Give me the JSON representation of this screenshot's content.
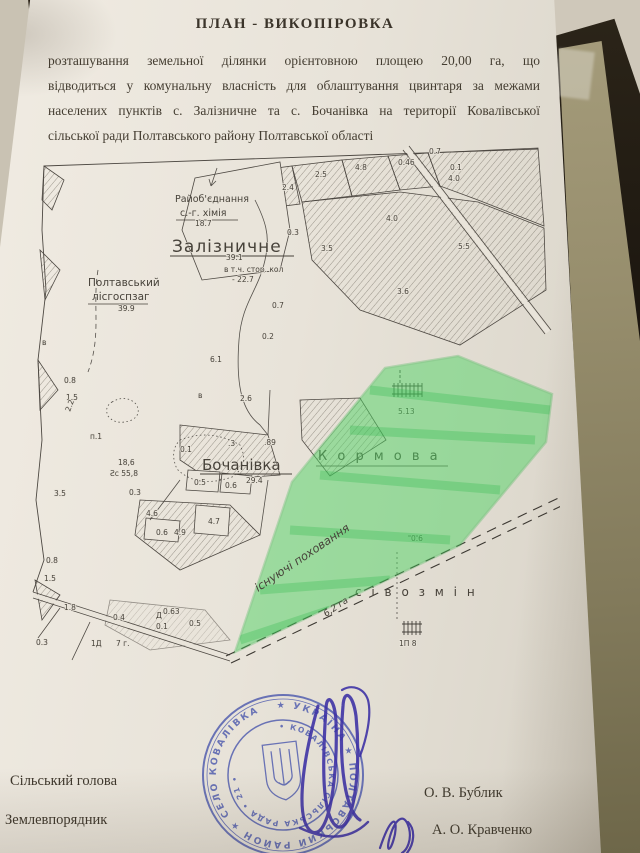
{
  "document": {
    "title": "ПЛАН - ВИКОПІРОВКА",
    "body_lines": [
      "розташування земельної  ділянки орієнтовною площею 20,00 га, що",
      "відводиться  у комунальну власність для облаштування цвинтаря за межами",
      "населених пунктів с. Залізничне та с. Бочанівка на території  Ковалівської",
      "сільської ради Полтавського району Полтавської області"
    ],
    "signatories": [
      {
        "role": "Сільський голова",
        "name": "О. В. Бублик"
      },
      {
        "role": "Землевпорядник",
        "name": "А. О. Кравченко"
      }
    ]
  },
  "map": {
    "place_labels": {
      "rayob_line1": "Райоб'єднання",
      "rayob_line2": "с.-г. хімія",
      "zaliznychne": "Залізничне",
      "poltav_line1": "Полтавський",
      "poltav_line2": "лісгоспзаг",
      "bochanivka": "Бочанівка",
      "kormova": "К о р м о в а",
      "sivozmin": "с і в о з м і н"
    },
    "green_note_line1": "існуючі поховання",
    "green_note_line2": "6,2 га",
    "area_labels": [
      {
        "v": "18.7",
        "x": 165,
        "y": 86
      },
      {
        "v": "39.1",
        "x": 196,
        "y": 120,
        "s": 10
      },
      {
        "v": "в т.ч. стор. кол",
        "x": 194,
        "y": 132,
        "s": 6.5
      },
      {
        "v": "- 22.7",
        "x": 202,
        "y": 142,
        "s": 8
      },
      {
        "v": "39.9",
        "x": 88,
        "y": 171,
        "s": 9
      },
      {
        "v": "2.4",
        "x": 252,
        "y": 50
      },
      {
        "v": "2.5",
        "x": 285,
        "y": 37
      },
      {
        "v": "4.8",
        "x": 325,
        "y": 30
      },
      {
        "v": "0.46",
        "x": 368,
        "y": 25,
        "s": 6.5
      },
      {
        "v": "0.7",
        "x": 399,
        "y": 14
      },
      {
        "v": "0.1",
        "x": 420,
        "y": 30
      },
      {
        "v": "4.0",
        "x": 418,
        "y": 41
      },
      {
        "v": "4.0",
        "x": 356,
        "y": 81,
        "s": 9
      },
      {
        "v": "0.3",
        "x": 257,
        "y": 95,
        "s": 6.5
      },
      {
        "v": "3.5",
        "x": 291,
        "y": 111,
        "s": 9
      },
      {
        "v": "5.5",
        "x": 428,
        "y": 109
      },
      {
        "v": "3.6",
        "x": 367,
        "y": 154
      },
      {
        "v": "0.7",
        "x": 242,
        "y": 168
      },
      {
        "v": "0.2",
        "x": 232,
        "y": 199,
        "s": 6.5
      },
      {
        "v": "6.1",
        "x": 180,
        "y": 222,
        "s": 8.5
      },
      {
        "v": "2.6",
        "x": 210,
        "y": 261,
        "s": 9
      },
      {
        "v": "0.1",
        "x": 150,
        "y": 312
      },
      {
        "v": "п.1",
        "x": 60,
        "y": 299,
        "s": 7
      },
      {
        "v": "18,6",
        "x": 88,
        "y": 325,
        "s": 8
      },
      {
        "v": "Ƨс 55,8",
        "x": 80,
        "y": 336,
        "s": 8.5
      },
      {
        "v": "0.5",
        "x": 164,
        "y": 345
      },
      {
        "v": "0.6",
        "x": 195,
        "y": 348
      },
      {
        "v": ".89",
        "x": 234,
        "y": 305,
        "s": 6.5
      },
      {
        "v": ".3",
        "x": 198,
        "y": 306,
        "s": 6.5
      },
      {
        "v": "29.4",
        "x": 216,
        "y": 343,
        "s": 12
      },
      {
        "v": "0.8",
        "x": 34,
        "y": 243,
        "s": 6.5
      },
      {
        "v": "1.5",
        "x": 36,
        "y": 260,
        "s": 6.5
      },
      {
        "v": "2.2",
        "x": 40,
        "y": 272,
        "s": 6.5,
        "r": -70
      },
      {
        "v": "3.5",
        "x": 24,
        "y": 356,
        "s": 8.5
      },
      {
        "v": "0.3",
        "x": 99,
        "y": 355
      },
      {
        "v": "4.6",
        "x": 116,
        "y": 376,
        "s": 8
      },
      {
        "v": "0.6",
        "x": 126,
        "y": 395
      },
      {
        "v": "4.9",
        "x": 144,
        "y": 395,
        "s": 8
      },
      {
        "v": "4.7",
        "x": 178,
        "y": 384,
        "s": 8.5
      },
      {
        "v": "0.8",
        "x": 16,
        "y": 423,
        "s": 6.5
      },
      {
        "v": "1.5",
        "x": 14,
        "y": 441,
        "s": 6.5
      },
      {
        "v": "1.8",
        "x": 34,
        "y": 470,
        "s": 7.5
      },
      {
        "v": "0.4",
        "x": 83,
        "y": 480
      },
      {
        "v": "Д",
        "x": 126,
        "y": 478,
        "s": 6.5
      },
      {
        "v": "0.63",
        "x": 133,
        "y": 474,
        "s": 6
      },
      {
        "v": "0.1",
        "x": 126,
        "y": 489
      },
      {
        "v": "0.5",
        "x": 159,
        "y": 486
      },
      {
        "v": "0.3",
        "x": 6,
        "y": 505,
        "s": 6.5
      },
      {
        "v": "1Д",
        "x": 61,
        "y": 506,
        "s": 7
      },
      {
        "v": "7 г.",
        "x": 86,
        "y": 506,
        "s": 7
      },
      {
        "v": "0.6",
        "x": 381,
        "y": 401
      },
      {
        "v": "5.13",
        "x": 368,
        "y": 274,
        "s": 8
      },
      {
        "v": "1П 8",
        "x": 369,
        "y": 506,
        "s": 7.5
      },
      {
        "v": "в",
        "x": 12,
        "y": 205,
        "s": 6
      },
      {
        "v": "в",
        "x": 168,
        "y": 258,
        "s": 6
      }
    ]
  },
  "stamp": {
    "outer_text": "★ УКРАЇНА ★ ПОЛТАВСЬКИЙ РАЙОН ★ СЕЛО КОВАЛІВКА",
    "inner_text": "• КОВАЛІВСЬКА СІЛЬСЬКА РАДА • 21 •"
  },
  "background": {
    "fragments": [
      "є-ПРО-РОС",
      "№ 1904-0413-4",
      "№ 2491-СГ. д",
      "Постанова  ро",
      "нотаріальна  діл",
      "ПРОЕ",
      "Зас",
      "Рай  В. д",
      "літична",
      "за  НЕОБ"
    ]
  },
  "colors": {
    "paper": "#e8e3d9",
    "ink": "#443d31",
    "map_ink": "#4d4842",
    "highlighter_green": "#57d66a",
    "stamp_blue": "#4a57ad",
    "signature_blue": "#3b2fa5",
    "folder_olive": "#938c6c",
    "backdrop_dark": "#18130d"
  }
}
